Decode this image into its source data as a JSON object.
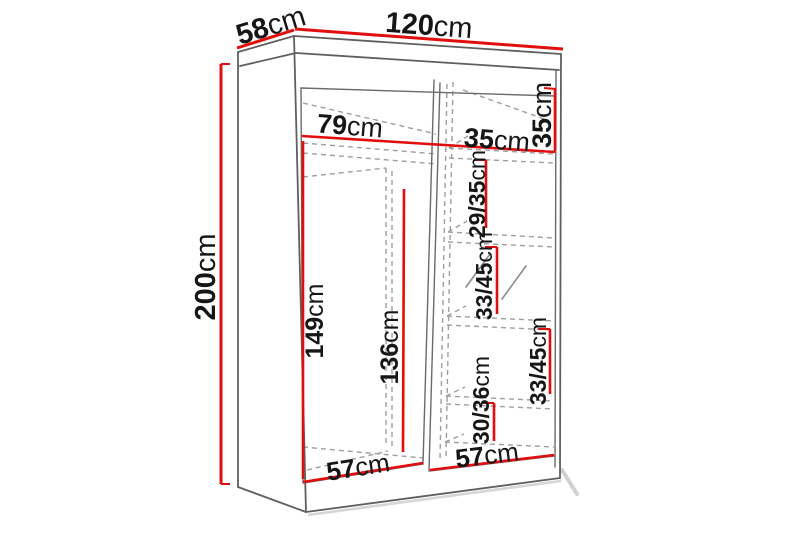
{
  "diagram": {
    "type": "furniture-dimension-drawing",
    "subject": "two-sliding-door wardrobe, perspective line drawing with red dimension lines",
    "colors": {
      "dimension_line": "#e20d0d",
      "outline": "#5f5f5f",
      "hidden_edge": "#9e9e9e",
      "text": "#161616",
      "background": "#ffffff"
    },
    "dimensions": {
      "width": {
        "value": "120",
        "unit": "cm"
      },
      "depth": {
        "value": "58",
        "unit": "cm"
      },
      "height": {
        "value": "200",
        "unit": "cm"
      },
      "left_section_width": {
        "value": "79",
        "unit": "cm"
      },
      "right_section_width": {
        "value": "35",
        "unit": "cm"
      },
      "top_shelf_height": {
        "value": "35",
        "unit": "cm"
      },
      "shelf_gap_1": {
        "value": "29/35",
        "unit": "cm"
      },
      "shelf_gap_2": {
        "value": "33/45",
        "unit": "cm"
      },
      "shelf_gap_3": {
        "value": "33/45",
        "unit": "cm"
      },
      "shelf_gap_4": {
        "value": "30/36",
        "unit": "cm"
      },
      "hanging_height": {
        "value": "149",
        "unit": "cm"
      },
      "inner_height": {
        "value": "136",
        "unit": "cm"
      },
      "left_door_width": {
        "value": "57",
        "unit": "cm"
      },
      "right_door_width": {
        "value": "57",
        "unit": "cm"
      }
    }
  }
}
